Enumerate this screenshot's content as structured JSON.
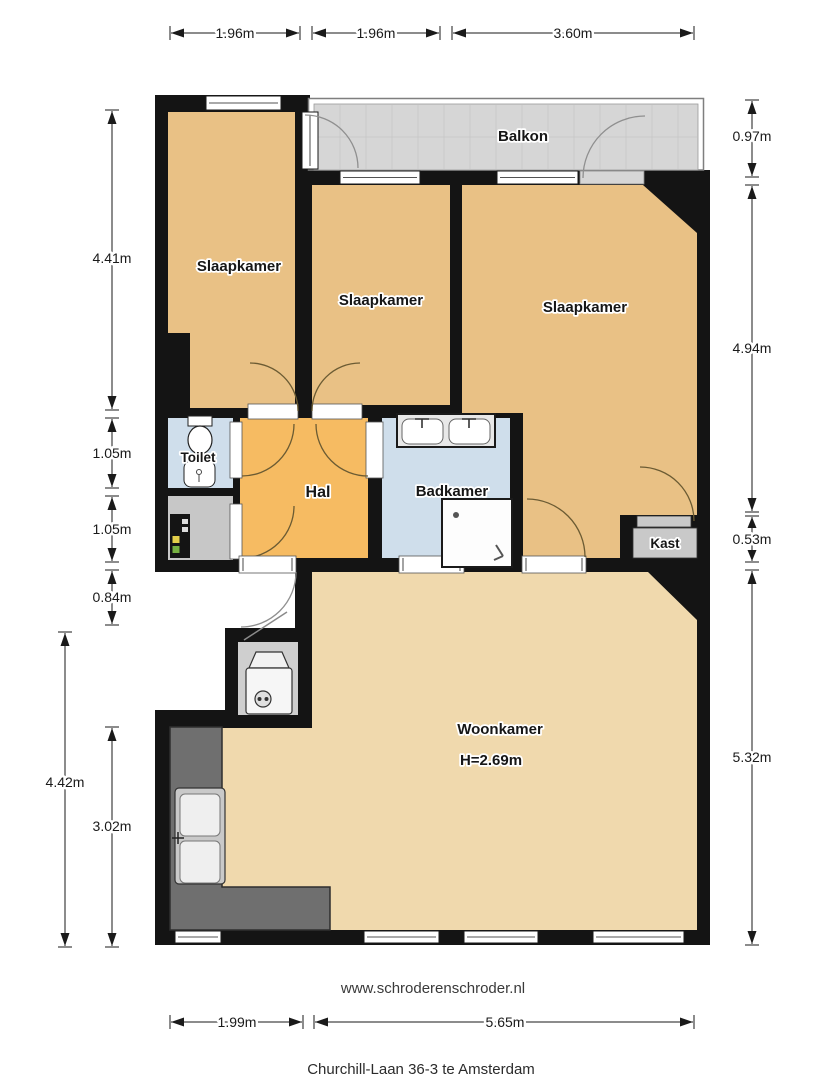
{
  "plan": {
    "footer_url": "www.schroderenschroder.nl",
    "footer_address": "Churchill-Laan 36-3 te Amsterdam",
    "rooms": {
      "balkon": "Balkon",
      "slaapkamer_left": "Slaapkamer",
      "slaapkamer_middle": "Slaapkamer",
      "slaapkamer_right": "Slaapkamer",
      "toilet": "Toilet",
      "hal": "Hal",
      "badkamer": "Badkamer",
      "kast": "Kast",
      "woonkamer": "Woonkamer",
      "woonkamer_ceiling_height": "H=2.69m"
    },
    "dimensions": {
      "top": [
        "1.96m",
        "1.96m",
        "3.60m"
      ],
      "left": [
        "4.41m",
        "1.05m",
        "1.05m",
        "0.84m",
        "4.42m",
        "3.02m"
      ],
      "right": [
        "0.97m",
        "4.94m",
        "0.53m",
        "5.32m"
      ],
      "bottom": [
        "1.99m",
        "5.65m"
      ]
    },
    "colors": {
      "bedroom_tan": "#e9c185",
      "hall_orange": "#f6bb62",
      "living_tan": "#f0d9ad",
      "wet_room_blue": "#cfdeeb",
      "balcony_grey": "#d6d6d6",
      "wall_black": "#141414"
    }
  }
}
